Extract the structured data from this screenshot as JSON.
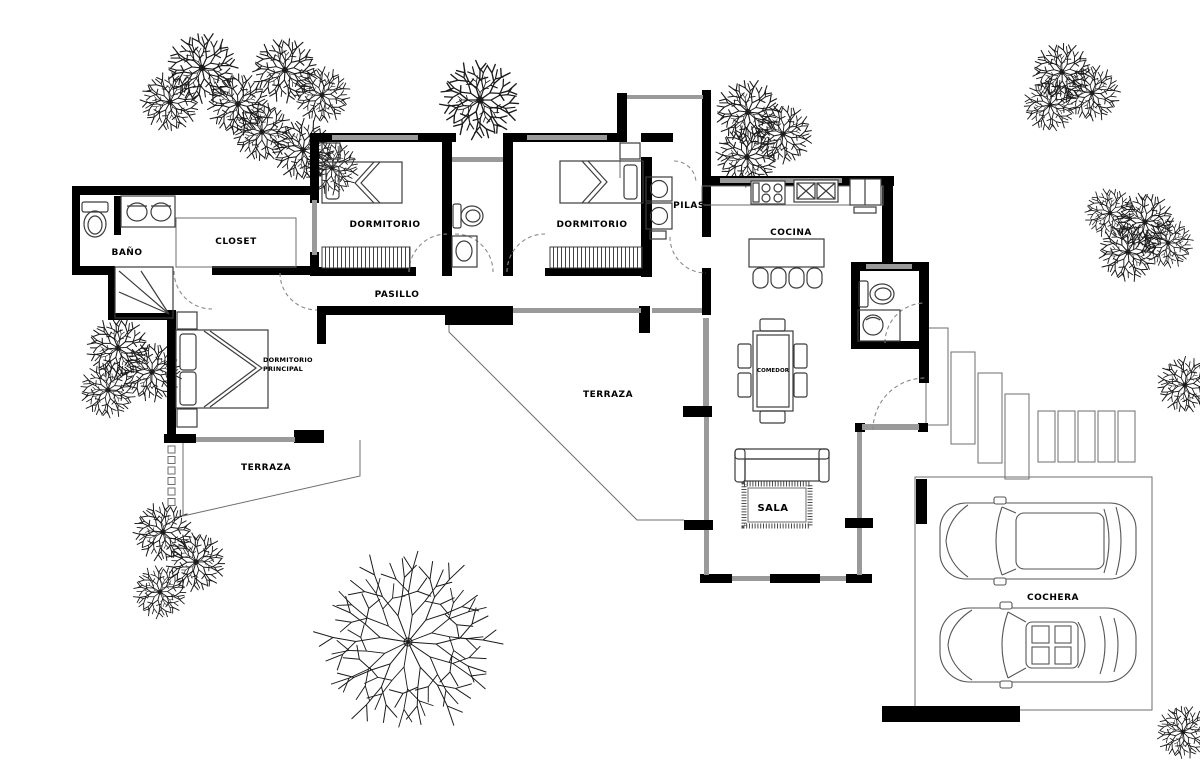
{
  "document": {
    "type": "architectural-floor-plan",
    "language": "es"
  },
  "palette": {
    "wall": "#000000",
    "window_line": "#9a9a9a",
    "fixture_line": "#3c3c3c",
    "thin_line": "#6e6e6e",
    "tree_line": "#1a1a1a",
    "background": "#ffffff"
  },
  "labels": {
    "bano": "BAÑO",
    "closet": "CLOSET",
    "dormitorio_1": "DORMITORIO",
    "dormitorio_2": "DORMITORIO",
    "pasillo": "PASILLO",
    "pilas": "PILAS",
    "cocina": "COCINA",
    "comedor": "COMEDOR",
    "dormitorio_principal_line_1": "DORMITORIO",
    "dormitorio_principal_line_2": "PRINCIPAL",
    "terraza_izquierda": "TERRAZA",
    "terraza_central": "TERRAZA",
    "sala": "SALA",
    "cochera": "COCHERA"
  }
}
